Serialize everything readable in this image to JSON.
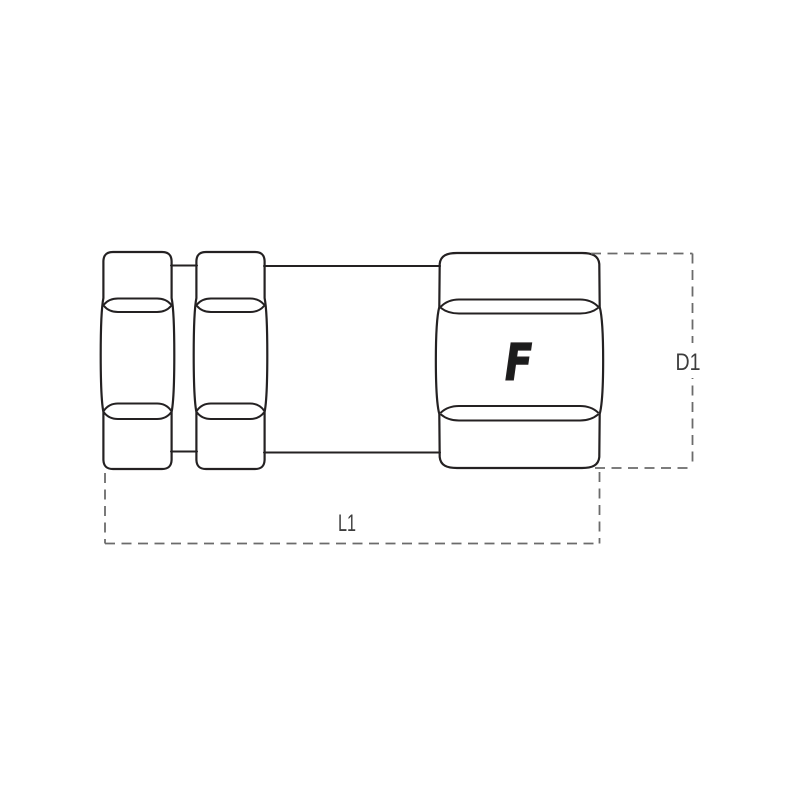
{
  "diagram": {
    "logo_letter": "F",
    "labels": {
      "length": "L1",
      "diameter": "D1"
    },
    "colors": {
      "background": "#ffffff",
      "outline": "#242122",
      "dimension_line": "#6b6b6b",
      "label_text": "#3d3d3d",
      "logo": "#1c1c1c"
    }
  }
}
